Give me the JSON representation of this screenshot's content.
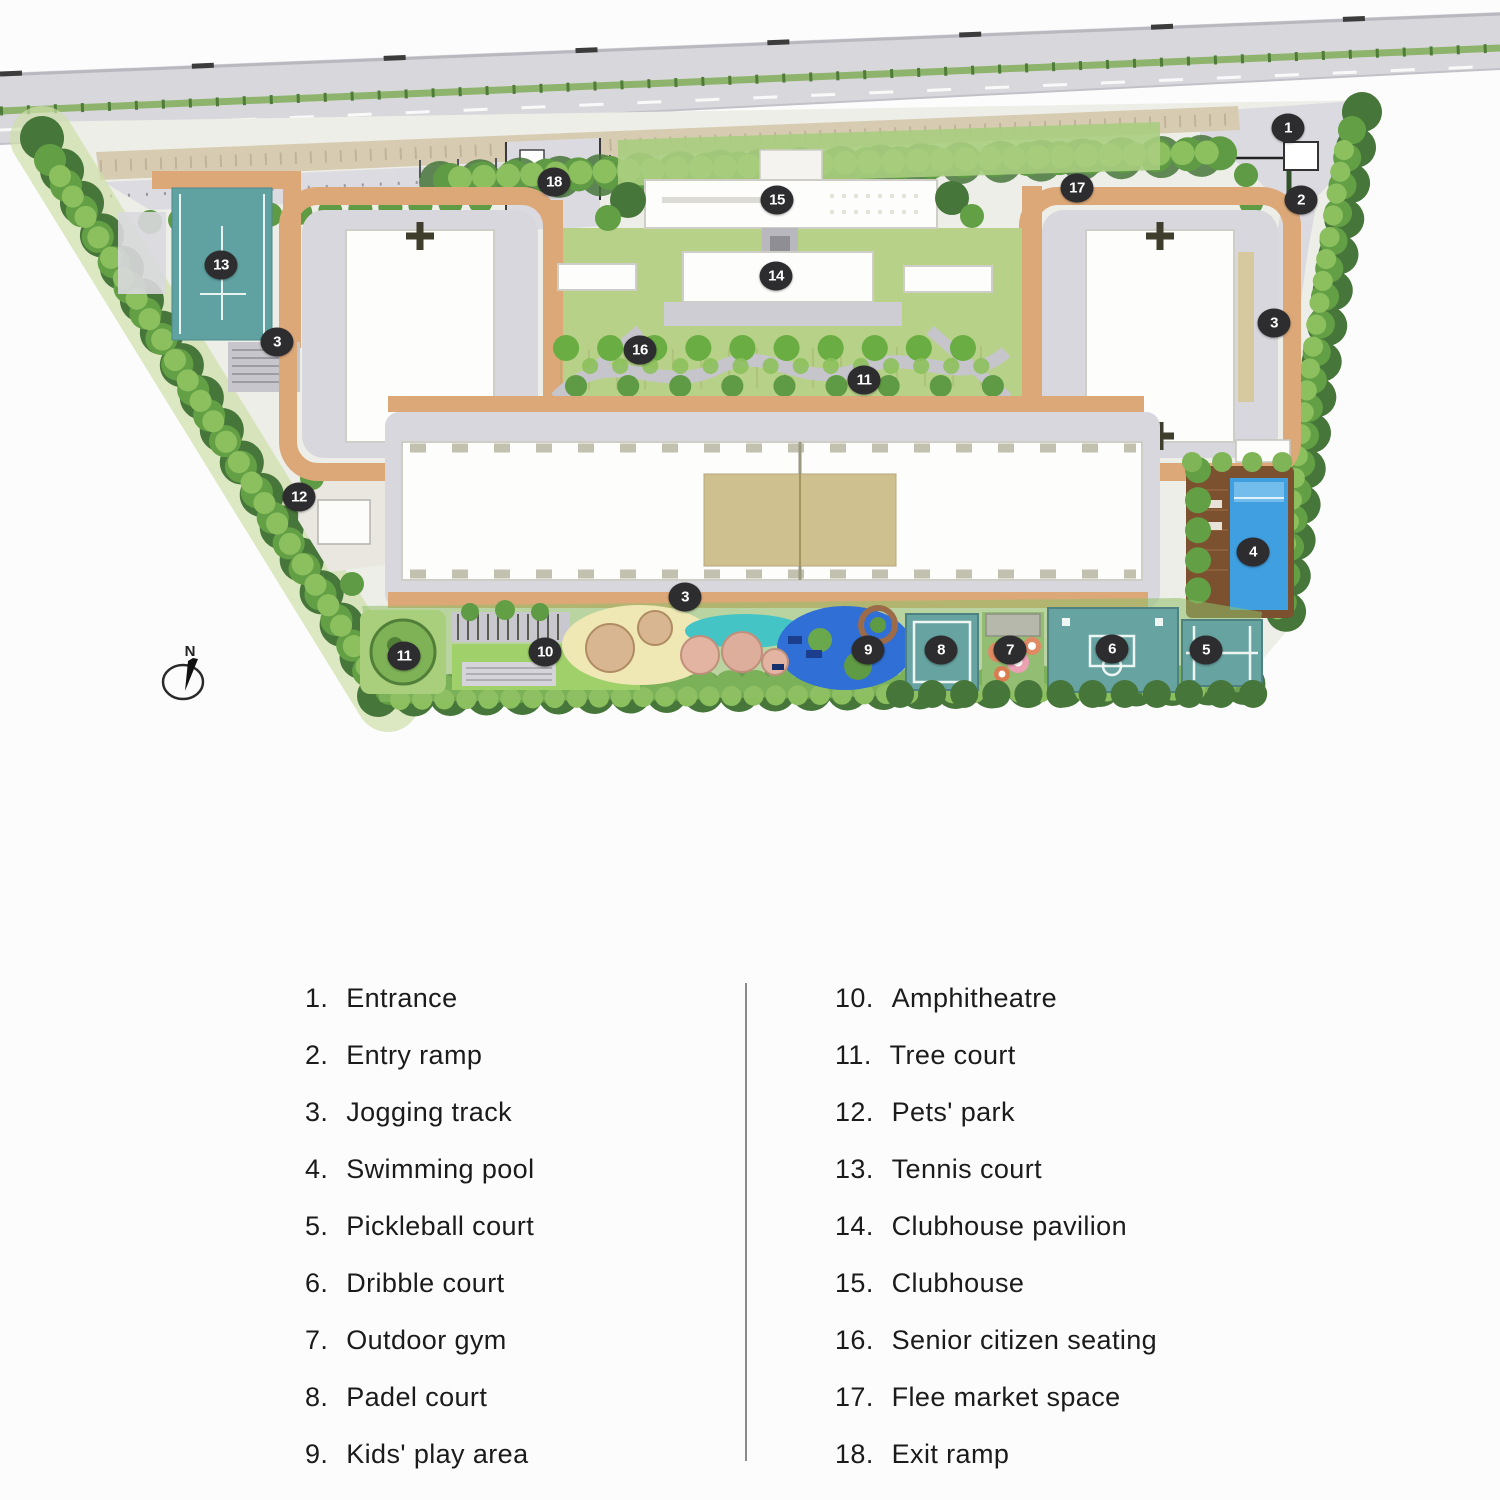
{
  "theme": {
    "colors": {
      "marker_bg": "#2d2c2e",
      "marker_text": "#ffffff",
      "legend_text": "#1b1b1b",
      "divider": "#8b8b8b",
      "road": "#d8d7dc",
      "gravel": "#d7ccb2",
      "site_base": "#edeee7",
      "plaza_grey": "#d8d7dd",
      "building_white": "#fdfdfc",
      "courtyard_khaki": "#cfc08f",
      "track_tan": "#dca878",
      "court_teal": "#66a3a1",
      "court_line": "#eef6f4",
      "pool_blue": "#3f9fe0",
      "pool_deck": "#7c5130",
      "lawn": "#9fd06a",
      "garden": "#b7d189",
      "tree_dark": "#47763a",
      "tree_mid": "#63a045",
      "tree_light": "#8cbf5e",
      "sand": "#efe8b4",
      "play_teal": "#45c4c6",
      "play_blue": "#2f6fd6"
    }
  },
  "map": {
    "compass": {
      "label": "N"
    },
    "markers": [
      {
        "n": "1",
        "x": 1288,
        "y": 128
      },
      {
        "n": "2",
        "x": 1301,
        "y": 200
      },
      {
        "n": "3",
        "x": 1274,
        "y": 323
      },
      {
        "n": "13",
        "x": 221,
        "y": 265
      },
      {
        "n": "3",
        "x": 277,
        "y": 342
      },
      {
        "n": "12",
        "x": 299,
        "y": 497
      },
      {
        "n": "18",
        "x": 554,
        "y": 182
      },
      {
        "n": "15",
        "x": 777,
        "y": 200
      },
      {
        "n": "14",
        "x": 776,
        "y": 276
      },
      {
        "n": "16",
        "x": 640,
        "y": 350
      },
      {
        "n": "11",
        "x": 864,
        "y": 380
      },
      {
        "n": "17",
        "x": 1077,
        "y": 188
      },
      {
        "n": "4",
        "x": 1253,
        "y": 552
      },
      {
        "n": "3",
        "x": 685,
        "y": 597
      },
      {
        "n": "11",
        "x": 404,
        "y": 656
      },
      {
        "n": "10",
        "x": 545,
        "y": 652
      },
      {
        "n": "9",
        "x": 868,
        "y": 650
      },
      {
        "n": "8",
        "x": 941,
        "y": 650
      },
      {
        "n": "7",
        "x": 1010,
        "y": 650
      },
      {
        "n": "6",
        "x": 1112,
        "y": 649
      },
      {
        "n": "5",
        "x": 1206,
        "y": 650
      }
    ]
  },
  "legend": {
    "left": [
      {
        "num": "1.",
        "label": "Entrance"
      },
      {
        "num": "2.",
        "label": "Entry ramp"
      },
      {
        "num": "3.",
        "label": "Jogging track"
      },
      {
        "num": "4.",
        "label": "Swimming pool"
      },
      {
        "num": "5.",
        "label": "Pickleball court"
      },
      {
        "num": "6.",
        "label": "Dribble court"
      },
      {
        "num": "7.",
        "label": "Outdoor gym"
      },
      {
        "num": "8.",
        "label": "Padel court"
      },
      {
        "num": "9.",
        "label": "Kids' play area"
      }
    ],
    "right": [
      {
        "num": "10.",
        "label": "Amphitheatre"
      },
      {
        "num": "11.",
        "label": "Tree court"
      },
      {
        "num": "12.",
        "label": "Pets' park"
      },
      {
        "num": "13.",
        "label": "Tennis court"
      },
      {
        "num": "14.",
        "label": "Clubhouse pavilion"
      },
      {
        "num": "15.",
        "label": "Clubhouse"
      },
      {
        "num": "16.",
        "label": "Senior citizen seating"
      },
      {
        "num": "17.",
        "label": "Flee market space"
      },
      {
        "num": "18.",
        "label": "Exit ramp"
      }
    ]
  }
}
